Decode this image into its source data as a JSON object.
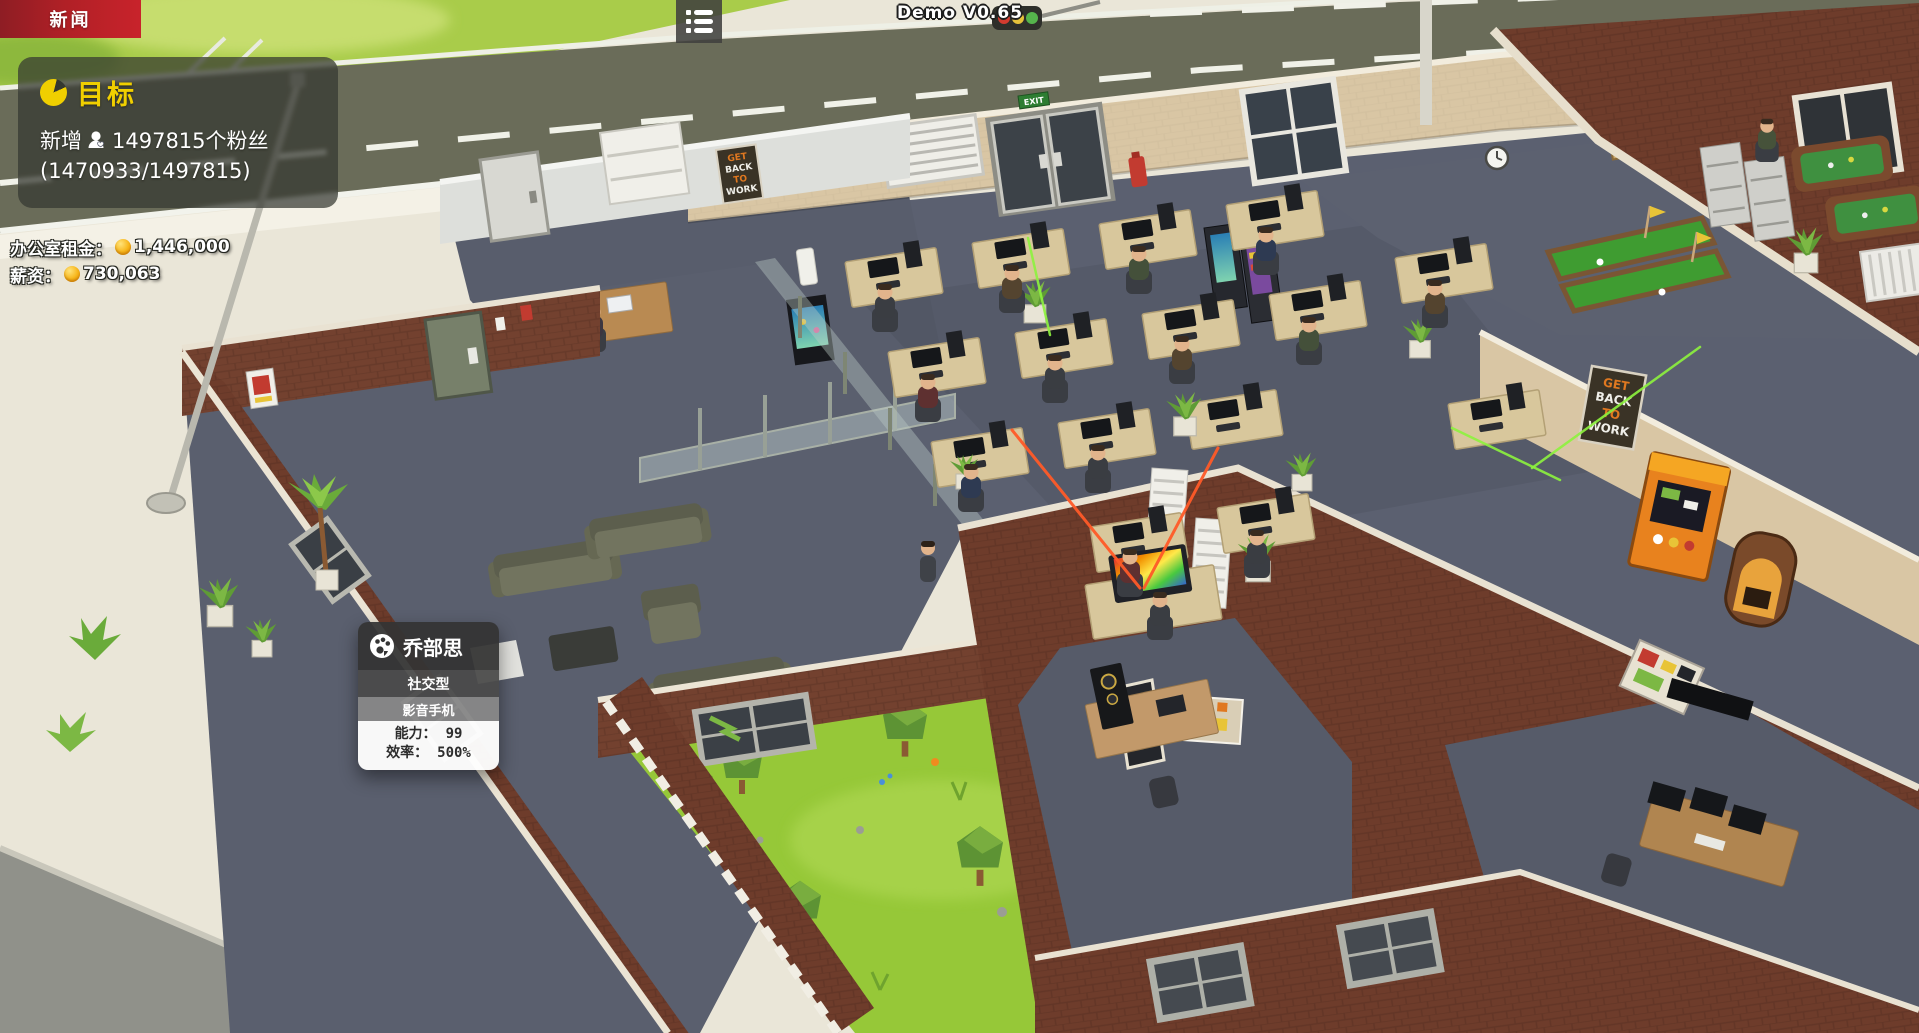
{
  "hud": {
    "news_badge": {
      "label": "新闻"
    },
    "menu_button": {
      "icon": "list-icon"
    },
    "version": "Demo V0.65",
    "goal_panel": {
      "title_icon": "pie-timer-icon",
      "title": "目标",
      "goal_prefix": "新增",
      "fans_icon": "person-heart-icon",
      "goal_suffix": "1497815个粉丝",
      "progress": "(1470933/1497815)"
    },
    "finance": {
      "coin_icon": "coin-icon",
      "rent_label": "办公室租金：",
      "rent_value": "1,446,000",
      "salary_label": "薪资：",
      "salary_value": "730,063"
    },
    "character_tooltip": {
      "icon": "palette-icon",
      "name": "乔部思",
      "personality": "社交型",
      "specialty": "影音手机",
      "stats": [
        {
          "label": "能力：",
          "value": "99"
        },
        {
          "label": "效率：",
          "value": "500%"
        }
      ]
    }
  },
  "scene": {
    "exit_sign": "EXIT",
    "poster_lines": [
      "GET",
      "BACK",
      "TO",
      "WORK"
    ],
    "traffic_light_colors": [
      "#d23b2f",
      "#e6c23a",
      "#55b44c"
    ],
    "colors": {
      "road": "#6a6c59",
      "grass": "#a9cc4a",
      "courtyard": "#96c838",
      "brick": "#6e3c2b",
      "carpet": "#5b6070",
      "beige_wall": "#d9c6a4",
      "pavement": "#eae6d8",
      "desk": "#d8c79c",
      "laser_green": "#8df33e",
      "laser_red": "#ff5a28"
    }
  }
}
